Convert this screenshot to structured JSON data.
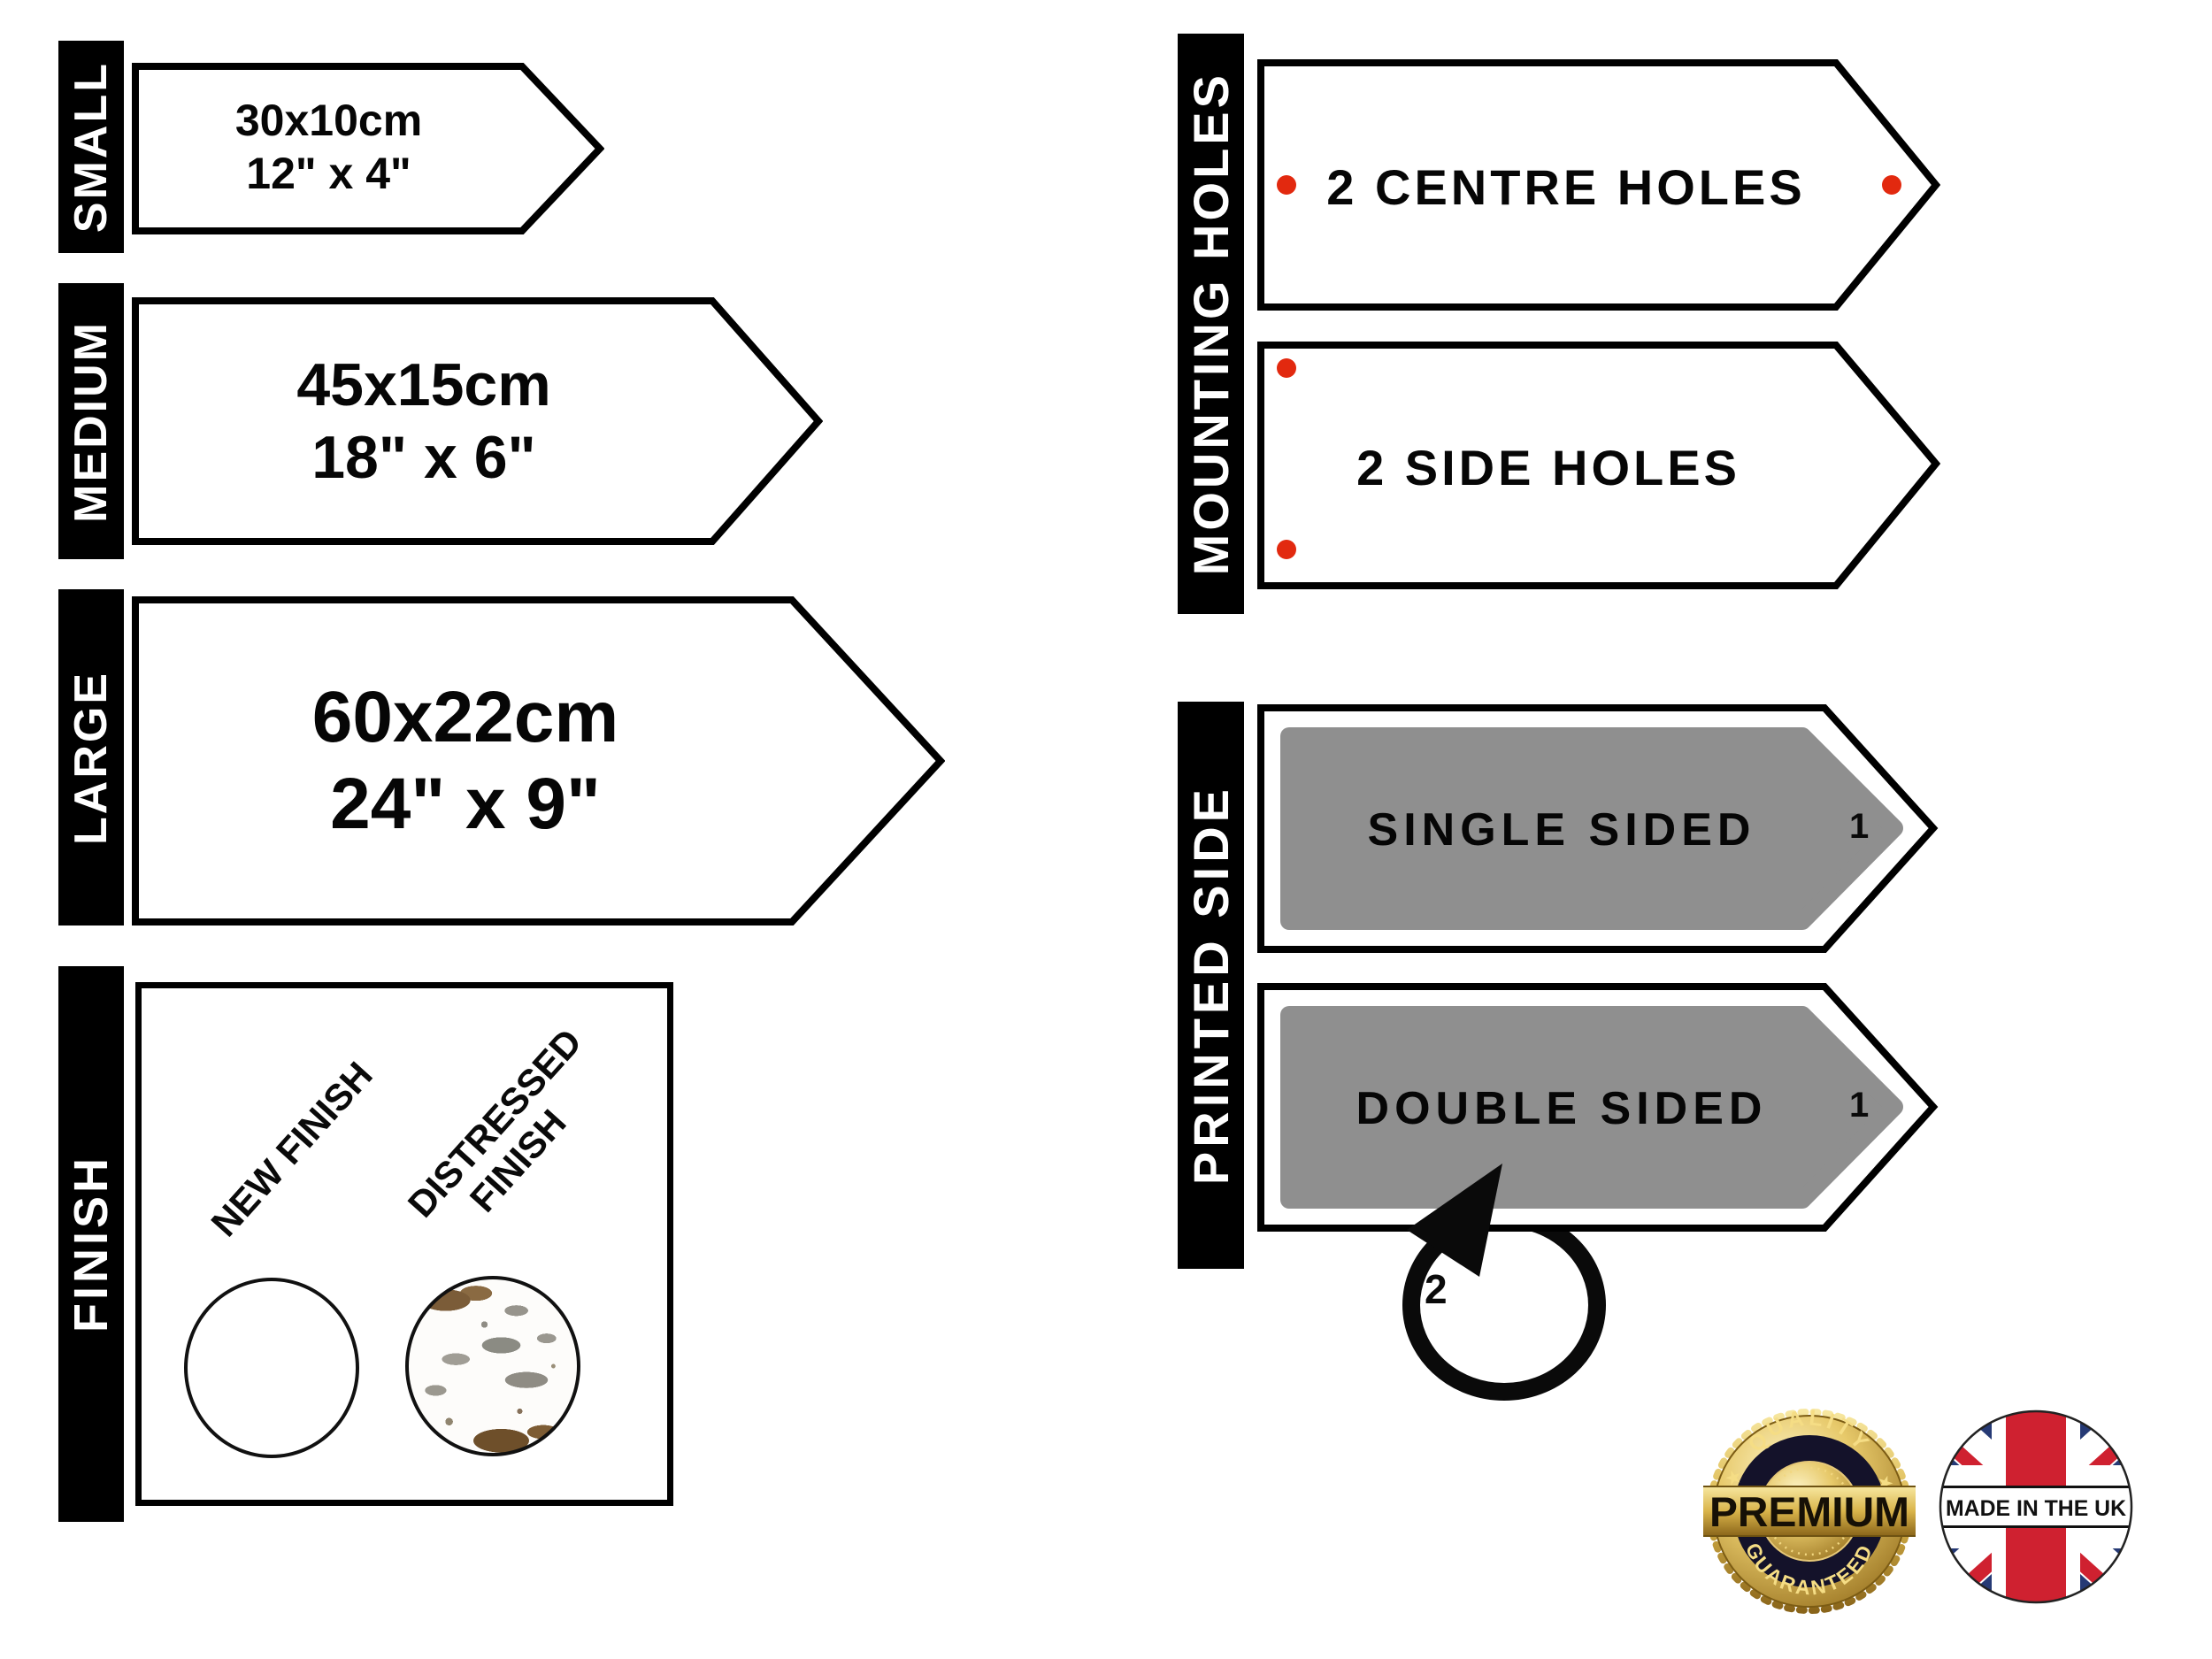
{
  "colors": {
    "accent_red": "#e2290f",
    "arrow_gray": "#8f8f8f",
    "ink": "#000000",
    "gold_light": "#f7e7a0",
    "gold_mid": "#d9b44a",
    "gold_dark": "#8a651a",
    "uk_blue": "#263a75",
    "uk_red": "#cf2130"
  },
  "sizes": {
    "items": [
      {
        "label": "SMALL",
        "metric": "30x10cm",
        "imperial": "12\" x 4\""
      },
      {
        "label": "MEDIUM",
        "metric": "45x15cm",
        "imperial": "18\" x 6\""
      },
      {
        "label": "LARGE",
        "metric": "60x22cm",
        "imperial": "24\" x 9\""
      }
    ]
  },
  "finish": {
    "label": "FINISH",
    "new_label": "NEW FINISH",
    "distressed_label": "DISTRESSED FINISH"
  },
  "mounting": {
    "label": "MOUNTING HOLES",
    "centre": "2 CENTRE HOLES",
    "side": "2 SIDE HOLES"
  },
  "printed": {
    "label": "PRINTED SIDE",
    "single": "SINGLE SIDED",
    "double": "DOUBLE SIDED",
    "front_number": "1",
    "back_number": "2"
  },
  "badges": {
    "premium": {
      "top": "QUALITY",
      "center": "PREMIUM",
      "bottom": "GUARANTEED",
      "star": "★"
    },
    "uk": {
      "text": "MADE IN THE UK"
    }
  }
}
